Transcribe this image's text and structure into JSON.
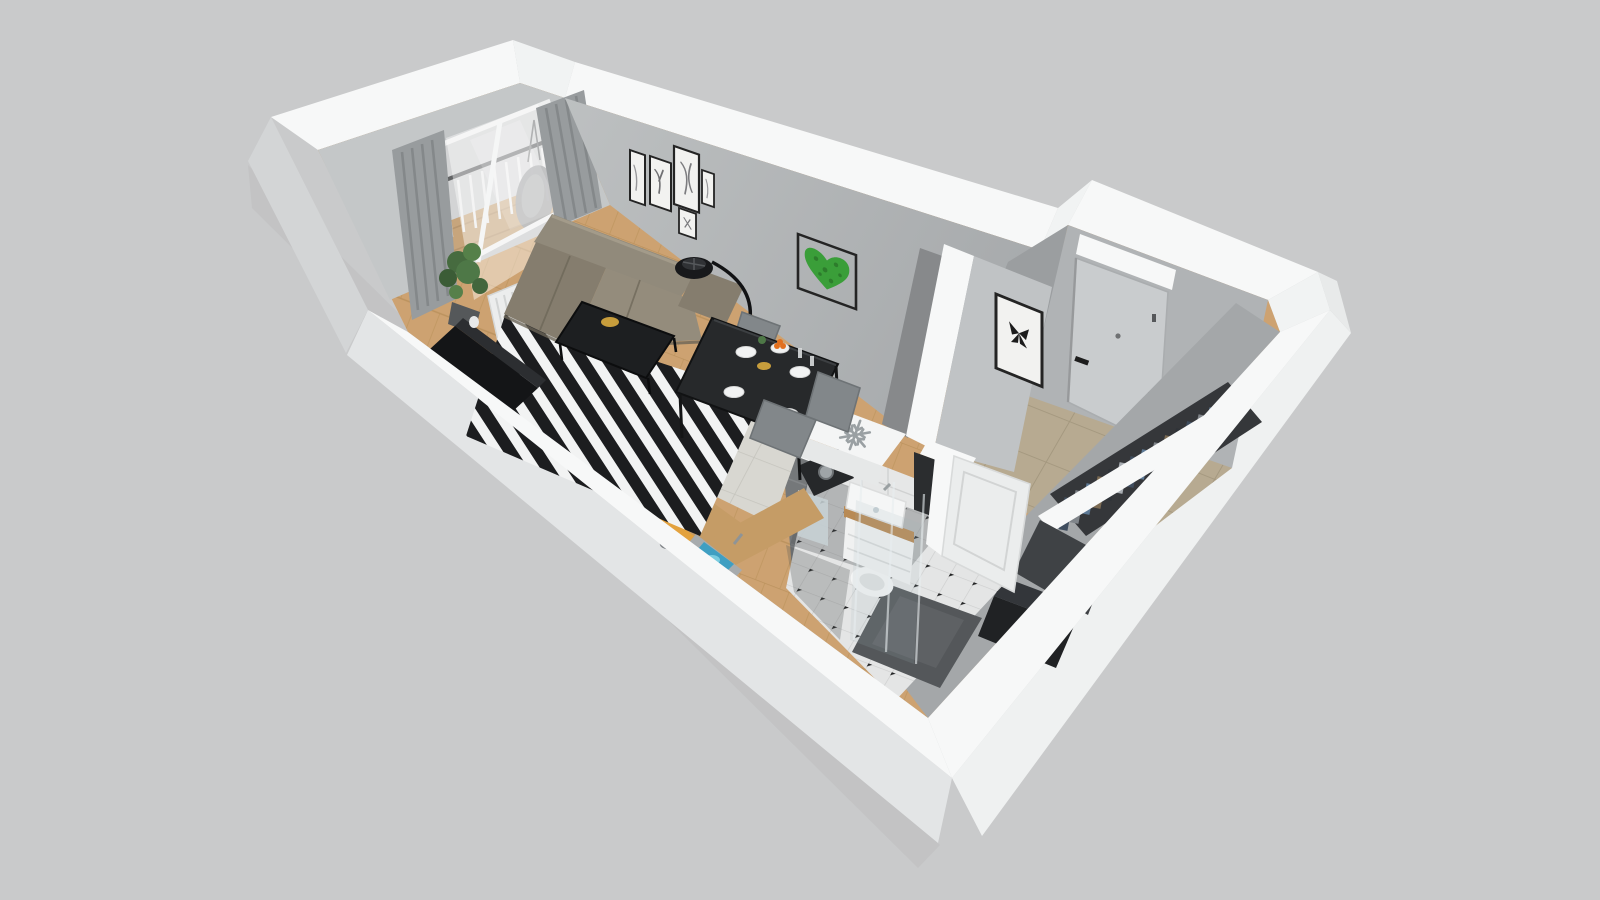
{
  "scene": {
    "kind": "3d-floorplan-cutaway-render",
    "description": "Top-down axonometric dollhouse render of a studio apartment on a plain gray background. No text is rendered in the image.",
    "rooms": [
      {
        "name": "living-room",
        "floor": "light wood planks with black and white striped rug",
        "furniture": [
          "corner-sofa",
          "coffee-table",
          "floor-lamp",
          "tv-sideboard",
          "dining-table",
          "dining-chairs-x4",
          "potted-plant",
          "radiator"
        ],
        "wall_decor": [
          "gallery-of-5-line-art-frames",
          "moss-heart-frame"
        ],
        "window": "balcony glass door with gray curtains and white sheer"
      },
      {
        "name": "kitchen",
        "floor": "large light gray tiles",
        "furniture": [
          "l-shaped-wood-counter",
          "cooktop-with-two-pots",
          "cutting-board",
          "blue-sink",
          "coffee-machine",
          "fridge-freezer-with-snowflake-top"
        ]
      },
      {
        "name": "hallway",
        "floor": "beige tiles",
        "furniture": [
          "entry-door-with-black-handle",
          "white-pelmet",
          "open-wardrobe-with-hanging-clothes",
          "black-dresser"
        ],
        "wall_decor": [
          "butterfly-frame"
        ]
      },
      {
        "name": "bathroom",
        "floor": "white octagon tiles with black dot accents",
        "furniture": [
          "vanity-with-sink",
          "mirror",
          "wall-hung-toilet",
          "glass-shower-with-dark-tray",
          "blue-towel",
          "paneled-door-ajar"
        ]
      },
      {
        "name": "balcony",
        "furniture": [
          "wood-deck",
          "railing-with-balusters",
          "hanging-chair"
        ]
      }
    ]
  },
  "colors": {
    "bg": "#c9cacb",
    "shellTop": "#f7f8f8",
    "shellTopSoft": "#f1f3f3",
    "faceLeft": "#d3d5d6",
    "faceBottomLeft": "#e3e5e6",
    "faceBottomRight": "#eff1f1",
    "wallBalcony": "#c4c7c8",
    "wallGalleryA": "#bdc0c1",
    "wallGalleryB": "#a8abad",
    "wallAlcove": "#b0b3b5",
    "wallReturn": "#9b9ea0",
    "wallRight": "#a4a7a9",
    "partitionDark": "#87898b",
    "partitionHall": "#c0c3c5",
    "floorWood": "#cda271",
    "floorWoodLine": "#b78f58",
    "tileKitchen": "#d8d7d1",
    "tileKitchenLine": "#c5c4bd",
    "tileHall": "#b7aa91",
    "tileHallLine": "#a3977e",
    "tileBath": "#e4e5e5",
    "tileBathLine": "#cdcece",
    "bathShadow": "#4e5254",
    "showerTray": "#54575a",
    "sofaBack": "#918a7b",
    "sofaSeat": "#948c7c",
    "sofaArm": "#857d6e",
    "sofaDark": "#6b6557",
    "rugDark": "#1c1d1f",
    "rugLight": "#f2f3f3",
    "tableBlack": "#27292b",
    "coffeeTable": "#1d1f21",
    "chairGray": "#82878a",
    "counterWood": "#c59c66",
    "cooktop": "#1a1b1c",
    "sinkBlue": "#3f9fc2",
    "sinkWater": "#7accdf",
    "fridgeWhite": "#f4f5f5",
    "snowflake": "#9aa0a3",
    "applianceDark": "#26282a",
    "mossGreen": "#3a9e39",
    "mossDark": "#2d7c2c",
    "plantGreen": "#4e7847",
    "curtain": "#989c9e",
    "curtainFold": "#84888a",
    "doorGray": "#c9ccce",
    "whiteDoor": "#ebeded",
    "gold": "#c79d3c",
    "orange": "#e2701f",
    "boardOrange": "#e3a23e",
    "towelTeal": "#3ba0bd",
    "closetBack": "#35373a",
    "closetFront": "#3f4245",
    "clothNavy": "#3f4d5e",
    "clothGray": "#80858a",
    "clothDenim": "#5d7995",
    "clothBrown": "#7b6a52",
    "clothDark": "#2f3338",
    "clothLight": "#a8adb2",
    "railWoodTone": "#cabd9f",
    "frameBlack": "#242424",
    "artPaper": "#f2f2f0"
  }
}
